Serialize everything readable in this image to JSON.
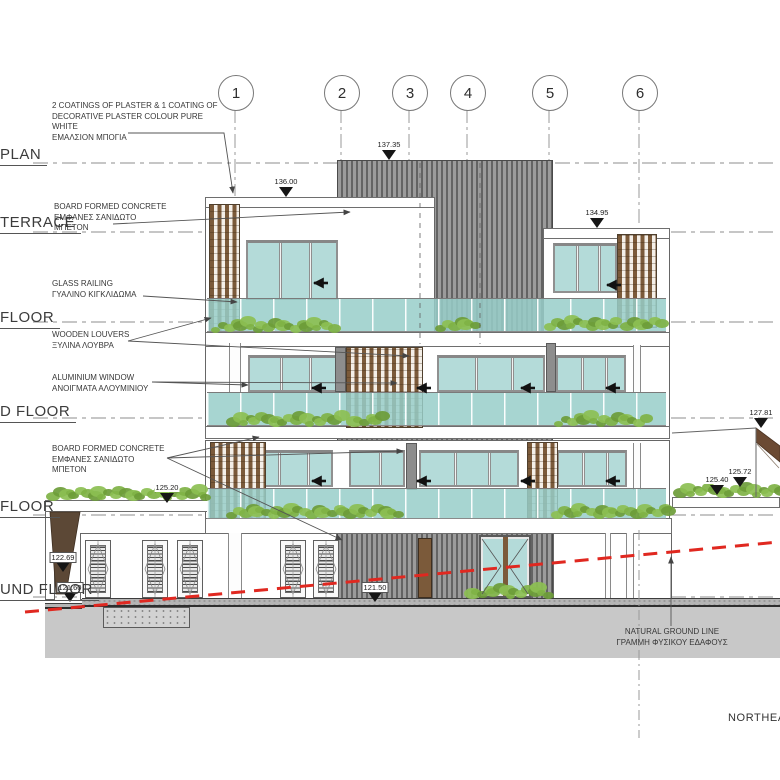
{
  "drawing": {
    "direction_label": "NORTHEAST"
  },
  "grid_bubbles": [
    {
      "label": "1",
      "x": 235
    },
    {
      "label": "2",
      "x": 341
    },
    {
      "label": "3",
      "x": 409
    },
    {
      "label": "4",
      "x": 467
    },
    {
      "label": "5",
      "x": 549
    },
    {
      "label": "6",
      "x": 639
    }
  ],
  "levels": [
    {
      "label": "PLAN",
      "text_y": 146,
      "line_y": 163
    },
    {
      "label": "TERRACE",
      "text_y": 214,
      "line_y": 232
    },
    {
      "label": "FLOOR",
      "text_y": 309,
      "line_y": 322
    },
    {
      "label": "D FLOOR",
      "text_y": 403,
      "line_y": 418
    },
    {
      "label": "FLOOR",
      "text_y": 498,
      "line_y": 515
    },
    {
      "label": "UND FLOOR",
      "text_y": 581,
      "line_y": 597
    }
  ],
  "annotations": [
    {
      "id": "plaster-coatings",
      "x": 52,
      "y": 101,
      "lines": [
        "2 COATINGS OF PLASTER & 1 COATING OF",
        "DECORATIVE PLASTER COLOUR PURE",
        "WHITE",
        "ΕΜΑΛΣΙΟΝ ΜΠΟΓΙΑ"
      ]
    },
    {
      "id": "board-formed-concrete-top",
      "x": 54,
      "y": 202,
      "lines": [
        "BOARD FORMED CONCRETE",
        "ΕΜΦΑΝΕΣ ΣΑΝΙΔΩΤΟ",
        "ΜΠΕΤΟΝ"
      ]
    },
    {
      "id": "glass-railing",
      "x": 52,
      "y": 279,
      "lines": [
        "GLASS RAILING",
        "ΓΥΑΛΙΝΟ ΚΙΓΚΛΙΔΩΜΑ"
      ]
    },
    {
      "id": "wooden-louvers",
      "x": 52,
      "y": 330,
      "lines": [
        "WOODEN LOUVERS",
        "ΞΥΛΙΝΑ ΛΟΥΒΡΑ"
      ]
    },
    {
      "id": "aluminium-window",
      "x": 52,
      "y": 373,
      "lines": [
        "ALUMINIUM WINDOW",
        "ΑΝΟΙΓΜΑΤΑ ΑΛΟΥΜΙΝΙΟΥ"
      ]
    },
    {
      "id": "board-formed-concrete-bottom",
      "x": 52,
      "y": 444,
      "lines": [
        "BOARD FORMED CONCRETE",
        "ΕΜΦΑΝΕΣ ΣΑΝΙΔΩΤΟ",
        "ΜΠΕΤΟΝ"
      ]
    },
    {
      "id": "natural-ground-line",
      "x": 672,
      "y": 627,
      "align": "center",
      "lines": [
        "NATURAL GROUND LINE",
        "ΓΡΑΜΜΗ ΦΥΣΙΚΟΥ ΕΔΑΦΟΥΣ"
      ]
    }
  ],
  "elevation_markers": [
    {
      "value": "137.35",
      "x": 389,
      "tip_y": 160,
      "boxed": false
    },
    {
      "value": "136.00",
      "x": 286,
      "tip_y": 197,
      "boxed": false
    },
    {
      "value": "134.95",
      "x": 597,
      "tip_y": 228,
      "boxed": false
    },
    {
      "value": "127.81",
      "x": 761,
      "tip_y": 428,
      "boxed": false
    },
    {
      "value": "125.72",
      "x": 740,
      "tip_y": 487,
      "boxed": false
    },
    {
      "value": "125.40",
      "x": 717,
      "tip_y": 495,
      "boxed": false
    },
    {
      "value": "125.20",
      "x": 167,
      "tip_y": 503,
      "boxed": false
    },
    {
      "value": "122.69",
      "x": 63,
      "tip_y": 572,
      "boxed": true
    },
    {
      "value": "121.60",
      "x": 70,
      "tip_y": 602,
      "boxed": true
    },
    {
      "value": "121.50",
      "x": 375,
      "tip_y": 602,
      "boxed": true
    }
  ],
  "colors": {
    "glass": "#b4dbd9",
    "louver_wood": "#7b5a3a",
    "core_gray": "#8f8f8f",
    "plant_green": "#7cae44",
    "ground_line_red": "#e02820",
    "earth_brown": "#5c4836",
    "ground_gray": "#c8c8c8"
  }
}
